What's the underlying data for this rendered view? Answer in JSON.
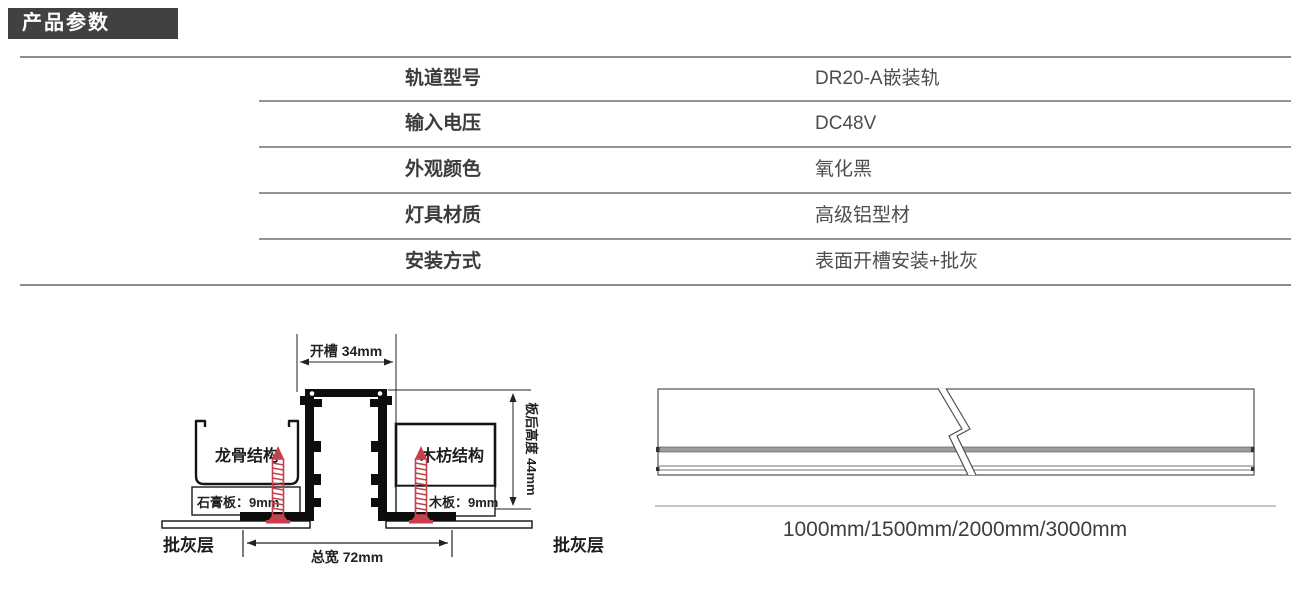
{
  "page": {
    "section_title": "产品参数"
  },
  "spec_table": {
    "rows": [
      {
        "label": "轨道型号",
        "value": "DR20-A嵌装轨"
      },
      {
        "label": "输入电压",
        "value": "DC48V"
      },
      {
        "label": "外观颜色",
        "value": "氧化黑"
      },
      {
        "label": "灯具材质",
        "value": "高级铝型材"
      },
      {
        "label": "安装方式",
        "value": "表面开槽安装+批灰"
      }
    ]
  },
  "cross_section_diagram": {
    "slot_width_label": "开槽 34mm",
    "keel_label": "龙骨结构",
    "gypsum_board_label": "石膏板：9mm",
    "wood_frame_label": "木枋结构",
    "wood_board_label": "木板：9mm",
    "putty_label_left": "批灰层",
    "putty_label_right": "批灰层",
    "total_width_label": "总宽 72mm",
    "board_height_label": "板后高度 44mm"
  },
  "rail_diagram": {
    "length_options": "1000mm/1500mm/2000mm/3000mm"
  },
  "colors": {
    "header_bg": "#414141",
    "screw_red": "#c5414e",
    "line_dark": "#141414"
  }
}
